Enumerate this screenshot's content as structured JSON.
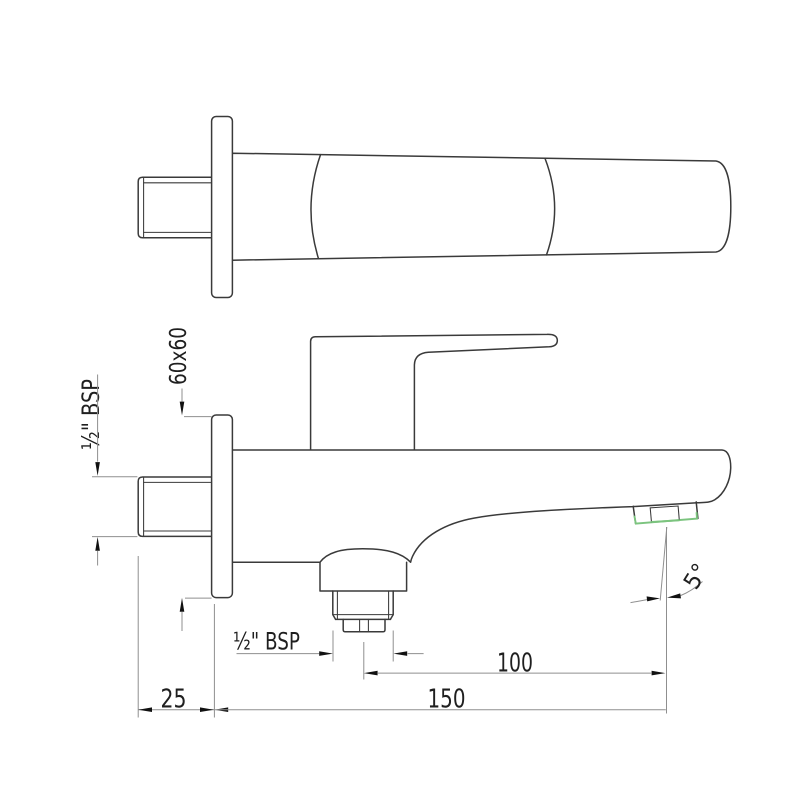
{
  "drawing": {
    "labels": {
      "dim_plate": "60x60",
      "dim_inlet_thread": "½\" BSP",
      "dim_diverter_thread": "½\" BSP",
      "dim_outlet_offset": "100",
      "dim_projection": "150",
      "dim_wall_gap": "25",
      "dim_angle": "5°"
    },
    "colors": {
      "outline": "#3a3a3a",
      "dimension_line": "#8f8f8f",
      "arrowhead": "#111111",
      "label_text": "#1f1f1f",
      "accent_green": "#7cc47f",
      "background": "#ffffff"
    }
  }
}
